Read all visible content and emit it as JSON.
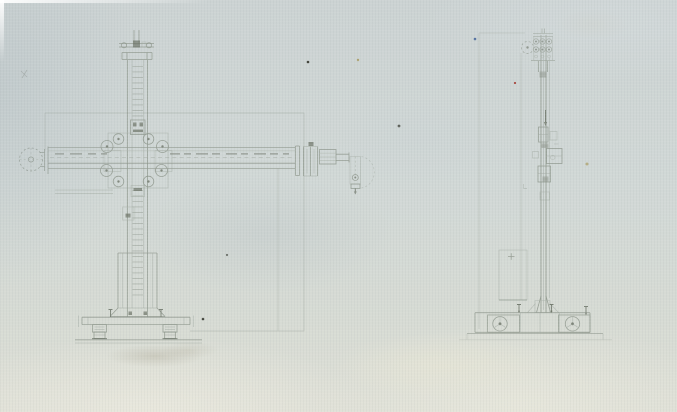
{
  "drawing": {
    "kind": "engineering-elevation-drawing",
    "visible_text": "none",
    "views": [
      {
        "id": "front-elevation",
        "position": "left"
      },
      {
        "id": "side-elevation",
        "position": "right"
      }
    ]
  },
  "colors": {
    "paper": "#d1d8d6",
    "paper-light": "#e2e3d9",
    "paper-dark": "#c3cccd",
    "line": "#8e968c",
    "line-dark": "#6d7468",
    "line-faint": "#a5ada4",
    "speck-dark": "#45473e",
    "speck-red": "#a84a42",
    "speck-blue": "#46659a",
    "speck-ochre": "#a3924f"
  }
}
